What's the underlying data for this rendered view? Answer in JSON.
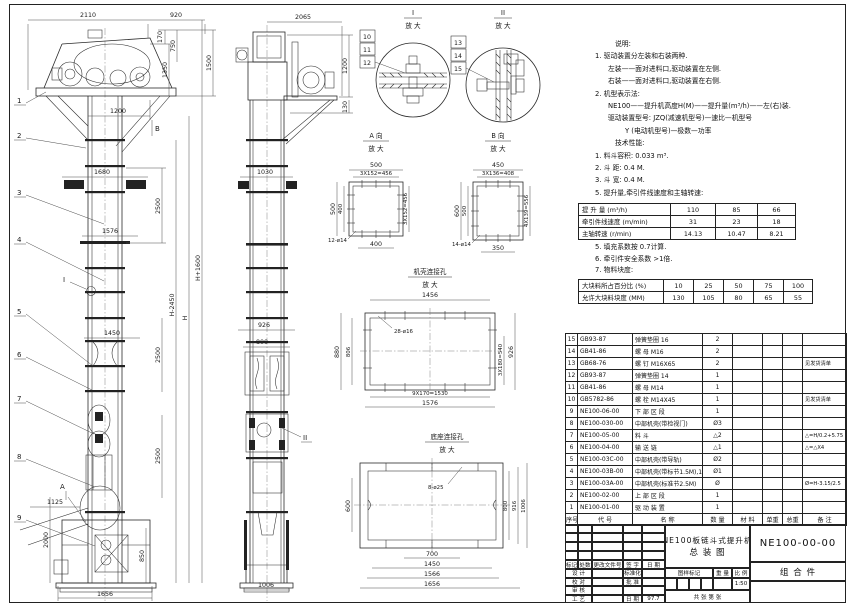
{
  "sheet": {
    "bg": "#ffffff",
    "line_color": "#2a2a2a"
  },
  "dims": {
    "fv_2110": "2110",
    "fv_920": "920",
    "fv_170": "170",
    "fv_750": "750",
    "fv_1350": "1350",
    "fv_1500": "1500",
    "fv_1200": "1200",
    "fv_B": "B",
    "fv_1680": "1680",
    "fv_2500a": "2500",
    "fv_1576": "1576",
    "fv_I": "I",
    "fv_Hm2450": "H-2450",
    "fv_H": "H",
    "fv_Hp1600": "H+1600",
    "fv_1450": "1450",
    "fv_2500b": "2500",
    "fv_2500c": "2500",
    "fv_1125": "1125",
    "fv_A": "A",
    "fv_2000": "2000",
    "fv_850": "850",
    "fv_1656": "1656",
    "sv_2065": "2065",
    "sv_1200": "1200",
    "sv_130": "130",
    "sv_1030": "1030",
    "sv_926": "926",
    "sv_800": "800",
    "sv_1006": "1006",
    "sv_II": "II",
    "va_500t": "500",
    "va_456t": "3X152=456",
    "va_500l": "500",
    "va_400l": "400",
    "va_456r": "3X152=456",
    "va_12d14": "12-ø14",
    "va_400b": "400",
    "vb_450": "450",
    "vb_408": "3X136=408",
    "vb_600": "600",
    "vb_500": "500",
    "vb_556r": "4X139=556",
    "vb_14d14": "14-ø14",
    "vb_350": "350",
    "cd_1456": "1456",
    "cd_28d16": "28-ø16",
    "cd_880": "880",
    "cd_806": "806",
    "cd_540": "3X180=540",
    "cd_926": "926",
    "cd_1530": "9X170=1530",
    "cd_1576": "1576",
    "bd_600": "600",
    "bd_8d25": "8-ø25",
    "bd_800": "800",
    "bd_916": "916",
    "bd_1006": "1006",
    "bd_700": "700",
    "bd_1450": "1450",
    "bd_1566": "1566",
    "bd_1656": "1656"
  },
  "balloons": {
    "n1": "1",
    "n2": "2",
    "n3": "3",
    "n4": "4",
    "n5": "5",
    "n6": "6",
    "n7": "7",
    "n8": "8",
    "n9": "9",
    "n10": "10",
    "n11": "11",
    "n12": "12",
    "n13": "13",
    "n14": "14",
    "n15": "15"
  },
  "details": {
    "di_title": "I",
    "di_sub": "放 大",
    "dii_title": "II",
    "dii_sub": "放 大",
    "va_title": "A 向",
    "va_sub": "放 大",
    "vb_title": "B 向",
    "vb_sub": "放 大",
    "cd_title": "机壳连接孔",
    "cd_sub": "放 大",
    "bd_title": "底座连接孔",
    "bd_sub": "放 大"
  },
  "notes": {
    "heading": "说明:",
    "lines": [
      "1. 驱动装置分左装和右装两种.",
      "左装——面对进料口,驱动装置在左侧.",
      "右装——面对进料口,驱动装置在右侧.",
      "2. 机型表示法:",
      "NE100——提升机高度H(M)——提升量(m³/h)——左(右)装.",
      "驱动装置型号: JZQ(减速机型号)—速比—机型号",
      "Y (电动机型号)—极数—功率"
    ],
    "tech_heading": "技术性能:",
    "tech_lines": [
      "1. 料斗容积: 0.033 m³.",
      "2. 斗  距: 0.4 M.",
      "3. 斗  宽: 0.4 M.",
      "5. 提升量,牵引件线速度和主轴转速:"
    ],
    "tech_lines2": [
      "5. 填充系数按 0.7计算.",
      "6. 牵引件安全系数 >1倍.",
      "7. 物料块度:"
    ]
  },
  "speed_table": {
    "rows": [
      {
        "label": "提 升 量 (m³/h)",
        "values": [
          "110",
          "85",
          "66"
        ]
      },
      {
        "label": "牵引件线速度 (m/min)",
        "values": [
          "31",
          "23",
          "18"
        ]
      },
      {
        "label": "主轴转速 (r/min)",
        "values": [
          "14.13",
          "10.47",
          "8.21"
        ]
      }
    ]
  },
  "lump_table": {
    "rows": [
      {
        "label": "大块料所占百分比 (%)",
        "values": [
          "10",
          "25",
          "50",
          "75",
          "100"
        ]
      },
      {
        "label": "允许大块料块度 (MM)",
        "values": [
          "130",
          "105",
          "80",
          "65",
          "55"
        ]
      }
    ]
  },
  "bom": {
    "headers": [
      "序号",
      "代  号",
      "名  称",
      "数 量",
      "材  料",
      "单重",
      "总重",
      "备  注"
    ],
    "rows": [
      {
        "no": "15",
        "code": "GB93-87",
        "name": "弹簧垫圈  16",
        "qty": "2",
        "mat": "",
        "unit": "",
        "total": "",
        "note": ""
      },
      {
        "no": "14",
        "code": "GB41-86",
        "name": "螺  母  M16",
        "qty": "2",
        "mat": "",
        "unit": "",
        "total": "",
        "note": ""
      },
      {
        "no": "13",
        "code": "GB68-76",
        "name": "螺  钉  M16X65",
        "qty": "2",
        "mat": "",
        "unit": "",
        "total": "",
        "note": "见发货清单"
      },
      {
        "no": "12",
        "code": "GB93-87",
        "name": "弹簧垫圈  14",
        "qty": "1",
        "mat": "",
        "unit": "",
        "total": "",
        "note": ""
      },
      {
        "no": "11",
        "code": "GB41-86",
        "name": "螺  母  M14",
        "qty": "1",
        "mat": "",
        "unit": "",
        "total": "",
        "note": ""
      },
      {
        "no": "10",
        "code": "GB5782-86",
        "name": "螺  栓  M14X45",
        "qty": "1",
        "mat": "",
        "unit": "",
        "total": "",
        "note": "见发货清单"
      },
      {
        "no": "9",
        "code": "NE100-06-00",
        "name": "下 部 区 段",
        "qty": "1",
        "mat": "",
        "unit": "",
        "total": "",
        "note": ""
      },
      {
        "no": "8",
        "code": "NE100-030-00",
        "name": "中部机壳(带检视门)",
        "qty": "Ø3",
        "mat": "",
        "unit": "",
        "total": "",
        "note": ""
      },
      {
        "no": "7",
        "code": "NE100-05-00",
        "name": "料  斗",
        "qty": "△2",
        "mat": "",
        "unit": "",
        "total": "",
        "note": "△=H/0.2+5.75"
      },
      {
        "no": "6",
        "code": "NE100-04-00",
        "name": "输 送 链",
        "qty": "△1",
        "mat": "",
        "unit": "",
        "total": "",
        "note": "△=△X4"
      },
      {
        "no": "5",
        "code": "NE100-03C-00",
        "name": "中部机壳(带导轨)",
        "qty": "Ø2",
        "mat": "",
        "unit": "",
        "total": "",
        "note": ""
      },
      {
        "no": "4",
        "code": "NE100-03B-00",
        "name": "中部机壳(带标节1.5M),1(M)",
        "qty": "Ø1",
        "mat": "",
        "unit": "",
        "total": "",
        "note": ""
      },
      {
        "no": "3",
        "code": "NE100-03A-00",
        "name": "中部机壳(标准节2.5M)",
        "qty": "Ø",
        "mat": "",
        "unit": "",
        "total": "",
        "note": "Ø=H-3.15/2.5"
      },
      {
        "no": "2",
        "code": "NE100-02-00",
        "name": "上 部 区 段",
        "qty": "1",
        "mat": "",
        "unit": "",
        "total": "",
        "note": ""
      },
      {
        "no": "1",
        "code": "NE100-01-00",
        "name": "驱 动 装 置",
        "qty": "1",
        "mat": "",
        "unit": "",
        "total": "",
        "note": ""
      }
    ]
  },
  "title_block": {
    "rev_headers": [
      "标记",
      "处数",
      "更改文件号",
      "签 字",
      "日 期"
    ],
    "sig": [
      {
        "a": "设 计",
        "b": "标准化",
        "c": ""
      },
      {
        "a": "校 对",
        "b": "批 准",
        "c": ""
      },
      {
        "a": "审 核",
        "b": "",
        "c": ""
      },
      {
        "a": "工 艺",
        "b": "日 期",
        "c": "97.7"
      }
    ],
    "title_line1": "NE100板链斗式提升机",
    "title_line2": "总  装  图",
    "stamp_headers": [
      "图样标记",
      "重 量",
      "比 例"
    ],
    "scale": "1:50",
    "sheet_text": "共   张   第   张",
    "drawing_no": "NE100-00-00",
    "part_type": "组 合 件"
  }
}
